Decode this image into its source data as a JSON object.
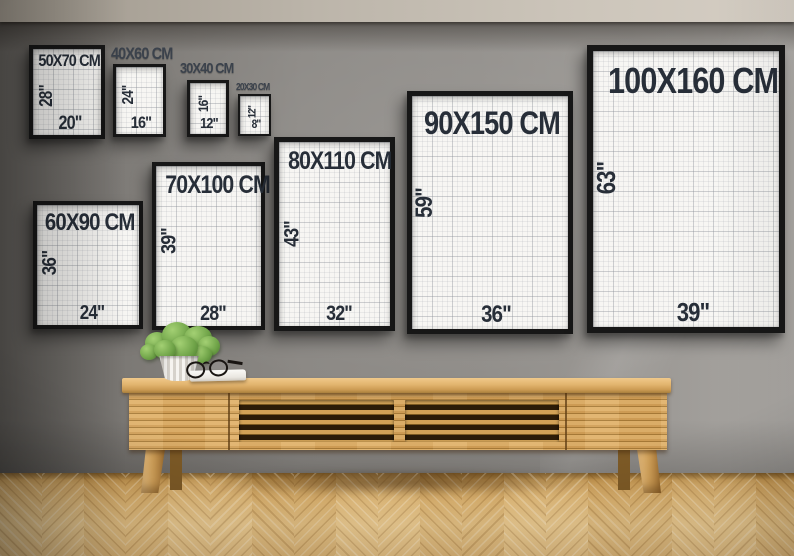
{
  "frames": [
    {
      "label": "50X70 CM",
      "cm_width": 50,
      "cm_height": 70,
      "height_in_label": "28\"",
      "width_in_label": "20\"",
      "label_placement": "inside"
    },
    {
      "label": "40X60 CM",
      "cm_width": 40,
      "cm_height": 60,
      "height_in_label": "24\"",
      "width_in_label": "16\"",
      "label_placement": "above"
    },
    {
      "label": "30X40 CM",
      "cm_width": 30,
      "cm_height": 40,
      "height_in_label": "16\"",
      "width_in_label": "12\"",
      "label_placement": "above"
    },
    {
      "label": "20X30 CM",
      "cm_width": 20,
      "cm_height": 30,
      "height_in_label": "12\"",
      "width_in_label": "8\"",
      "label_placement": "above"
    },
    {
      "label": "60X90 CM",
      "cm_width": 60,
      "cm_height": 90,
      "height_in_label": "36\"",
      "width_in_label": "24\"",
      "label_placement": "inside"
    },
    {
      "label": "70X100 CM",
      "cm_width": 70,
      "cm_height": 100,
      "height_in_label": "39\"",
      "width_in_label": "28\"",
      "label_placement": "inside"
    },
    {
      "label": "80X110 CM",
      "cm_width": 80,
      "cm_height": 110,
      "height_in_label": "43\"",
      "width_in_label": "32\"",
      "label_placement": "inside"
    },
    {
      "label": "90X150 CM",
      "cm_width": 90,
      "cm_height": 150,
      "height_in_label": "59\"",
      "width_in_label": "36\"",
      "label_placement": "inside"
    },
    {
      "label": "100X160 CM",
      "cm_width": 100,
      "cm_height": 160,
      "height_in_label": "63\"",
      "width_in_label": "39\"",
      "label_placement": "inside"
    }
  ],
  "scene": {
    "objects": [
      "poster-frames",
      "slatted-wood-sideboard",
      "potted-plant",
      "reading-glasses",
      "book",
      "herringbone-floor"
    ],
    "colors": {
      "wall": "#8b8884",
      "ceiling": "#cdc6bb",
      "floor_wood": "#e2ba77",
      "sideboard_wood": "#d2a058",
      "frame_border": "#171717",
      "poster_paper": "#f7f6f3",
      "poster_text": "#272e38",
      "wall_label_text": "#3b424c",
      "plant_green": "#6fa348",
      "pot_white": "#f6f4f0"
    }
  }
}
